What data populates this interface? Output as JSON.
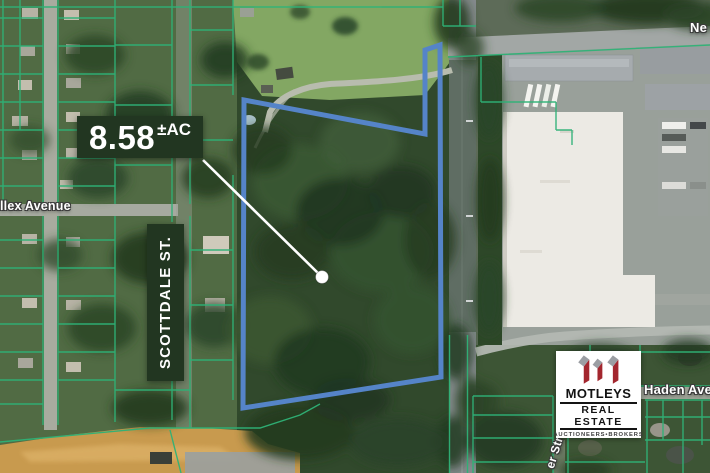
{
  "page": {
    "type": "property-aerial-flyer"
  },
  "parcel": {
    "acreage_value": "8.58",
    "acreage_unit": "±AC",
    "outline_color": "#5584c8"
  },
  "street_labels": {
    "allex": "llex Avenue",
    "scottdale": "SCOTTDALE ST.",
    "haden": "Haden Avenue",
    "top_right_partial": "Ne",
    "bottom_right_partial": "er Str"
  },
  "logo": {
    "name": "MOTLEYS",
    "division": "REAL ESTATE",
    "tagline": "AUCTIONEERS•BROKERS",
    "brand_red": "#a3262e",
    "brand_gray": "#9b9ea3"
  },
  "map_colors": {
    "lot_line_green": "#2fb277",
    "label_box_green": "#223621"
  }
}
